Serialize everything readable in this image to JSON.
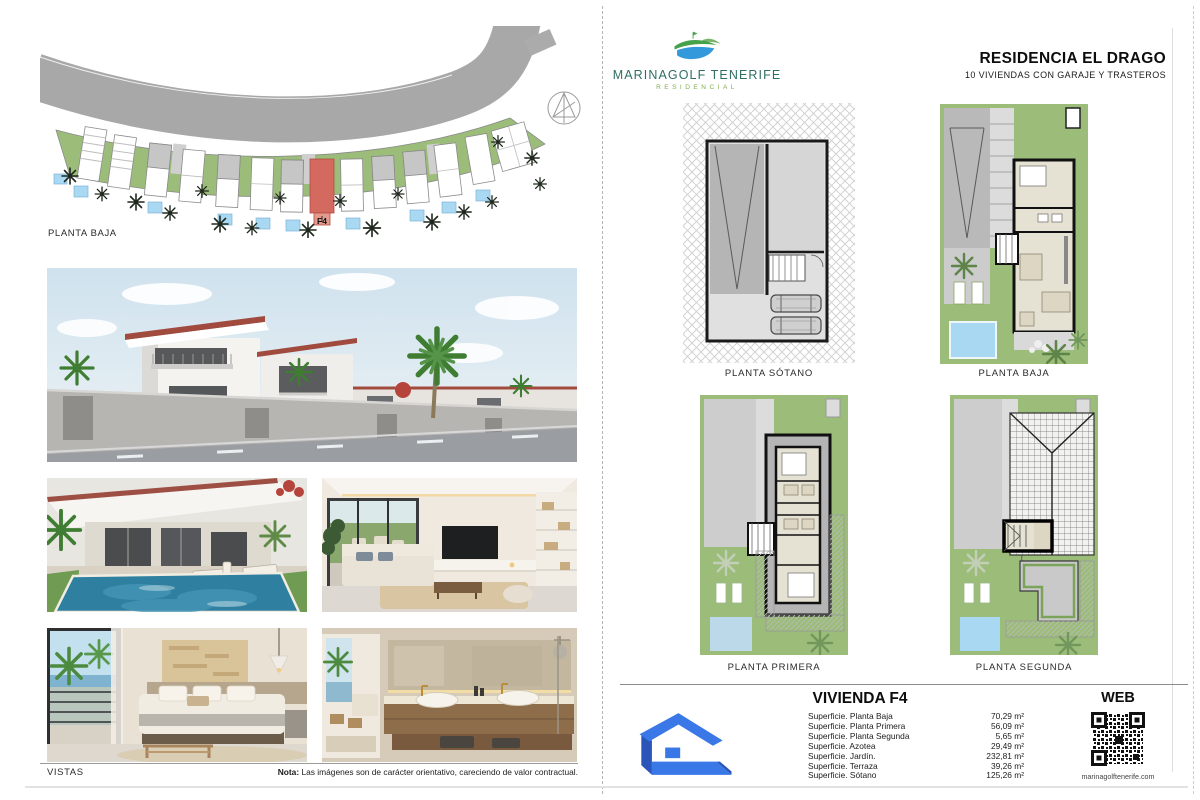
{
  "left_page": {
    "site_plan_label": "PLANTA BAJA",
    "site_plan_unit_label": "F4",
    "vistas_label": "VISTAS",
    "nota_bold": "Nota:",
    "nota_text": " Las imágenes son de carácter orientativo, careciendo de valor contractual."
  },
  "right_page": {
    "brand": {
      "name": "MARINAGOLF TENERIFE",
      "subtitle": "RESIDENCIAL"
    },
    "header": {
      "title": "RESIDENCIA EL DRAGO",
      "subtitle": "10 VIVIENDAS CON GARAJE Y TRASTEROS"
    },
    "floor_plans": [
      {
        "label": "PLANTA SÓTANO"
      },
      {
        "label": "PLANTA BAJA"
      },
      {
        "label": "PLANTA PRIMERA"
      },
      {
        "label": "PLANTA SEGUNDA"
      }
    ],
    "info_panel": {
      "title": "VIVIENDA F4",
      "surfaces": [
        {
          "label": "Superficie. Planta Baja",
          "value": "70,29 m²"
        },
        {
          "label": "Superficie. Planta Primera",
          "value": "56,09 m²"
        },
        {
          "label": "Superficie. Planta Segunda",
          "value": "5,65 m²"
        },
        {
          "label": "Superficie. Azotea",
          "value": "29,49 m²"
        },
        {
          "label": "Superficie. Jardín.",
          "value": "232,81 m²"
        },
        {
          "label": "Superficie. Terraza",
          "value": "39,26 m²"
        },
        {
          "label": "Superficie. Sótano",
          "value": "125,26 m²"
        }
      ],
      "web_label": "WEB",
      "web_url": "marinagolftenerife.com"
    }
  },
  "colors": {
    "logo-blue": "#3a78e8",
    "logo-blue-dark": "#2b55b8",
    "brand-teal": "#2e6e63",
    "brand-green": "#7fae4e",
    "unit-red": "#d4695f",
    "garden-green": "#9cbd7a",
    "pool-blue": "#a8d8f2",
    "road-gray": "#a8a8a8"
  }
}
